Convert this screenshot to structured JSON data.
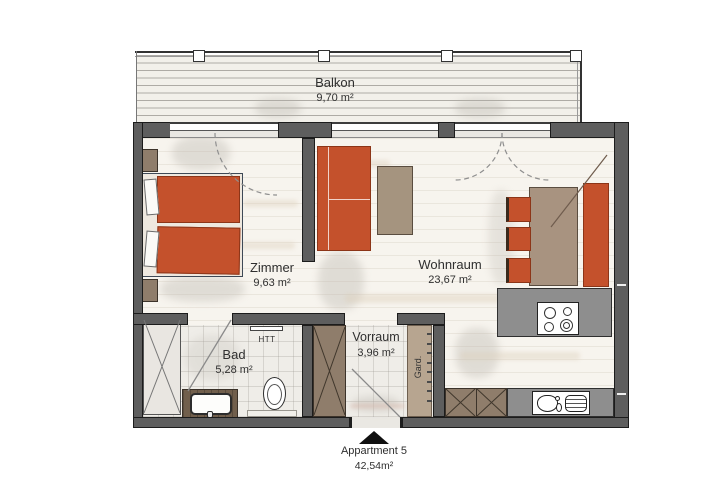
{
  "balcony": {
    "label": "Balkon",
    "area": "9,70 m²"
  },
  "rooms": {
    "zimmer": {
      "label": "Zimmer",
      "area": "9,63 m²"
    },
    "wohnraum": {
      "label": "Wohnraum",
      "area": "23,67 m²"
    },
    "bad": {
      "label": "Bad",
      "area": "5,28 m²"
    },
    "vorraum": {
      "label": "Vorraum",
      "area": "3,96 m²"
    }
  },
  "fixtures": {
    "towel_radiator": "HTT",
    "wardrobe_rail": "Gard."
  },
  "footer": {
    "title": "Appartment 5",
    "area": "42,54m²"
  },
  "colors": {
    "wall_gray": "#5e5e5e",
    "accent_orange": "#c4512c",
    "furniture_brown": "#8f7d6b",
    "table_taupe": "#a89380",
    "counter_gray": "#8e8e8e"
  }
}
